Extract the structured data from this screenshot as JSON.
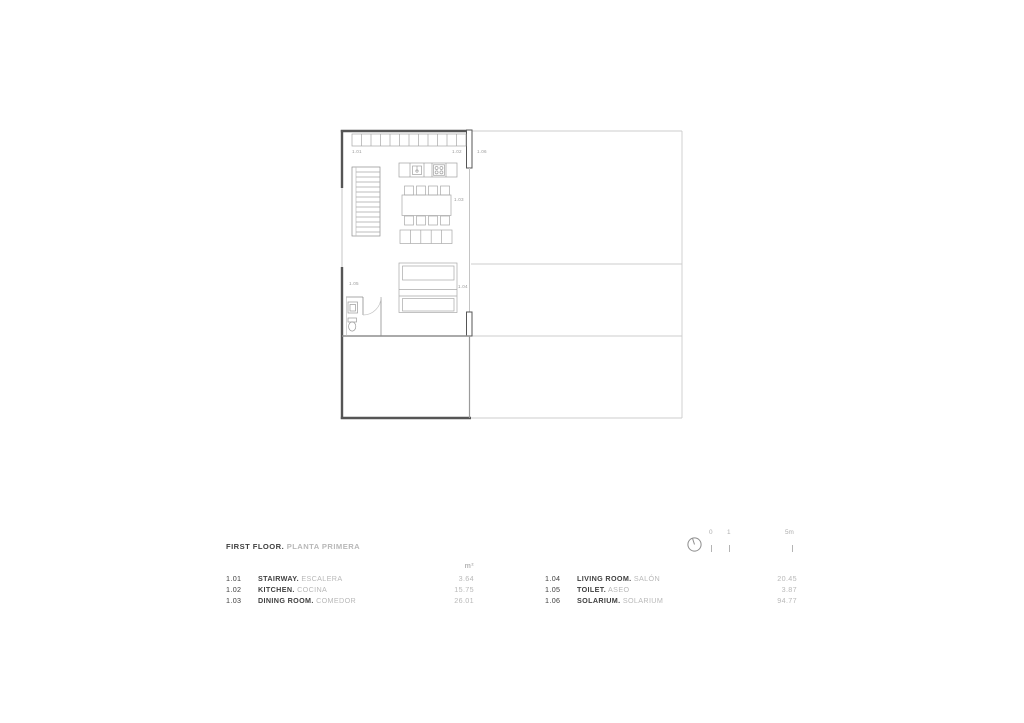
{
  "plan": {
    "labels": {
      "stairway": "1.01",
      "kitchen": "1.02",
      "dining_room": "1.03",
      "living_room": "1.04",
      "toilet": "1.05",
      "solarium": "1.06"
    }
  },
  "title_block": {
    "floor_en": "FIRST FLOOR.",
    "floor_es": "PLANTA PRIMERA"
  },
  "scale_bar": {
    "tick_0": "0",
    "tick_1": "1",
    "tick_5": "5m"
  },
  "legend": {
    "unit": "m²",
    "left": [
      {
        "code": "1.01",
        "name_en": "STAIRWAY.",
        "name_es": "ESCALERA",
        "area": "3.64"
      },
      {
        "code": "1.02",
        "name_en": "KITCHEN.",
        "name_es": "COCINA",
        "area": "15.75"
      },
      {
        "code": "1.03",
        "name_en": "DINING ROOM.",
        "name_es": "COMEDOR",
        "area": "26.01"
      }
    ],
    "right": [
      {
        "code": "1.04",
        "name_en": "LIVING ROOM.",
        "name_es": "SALÓN",
        "area": "20.45"
      },
      {
        "code": "1.05",
        "name_en": "TOILET.",
        "name_es": "ASEO",
        "area": "3.87"
      },
      {
        "code": "1.06",
        "name_en": "SOLARIUM.",
        "name_es": "SOLARIUM",
        "area": "94.77"
      }
    ]
  },
  "colors": {
    "wall": "#555555",
    "window_line": "#c4c4c4",
    "solarium_line": "#cccccc",
    "furniture": "#a8a8a8",
    "interior_wall": "#8d8d8d",
    "label": "#9a9a9a",
    "text_dark": "#3f3f3f",
    "text_light": "#b8b8b8"
  }
}
